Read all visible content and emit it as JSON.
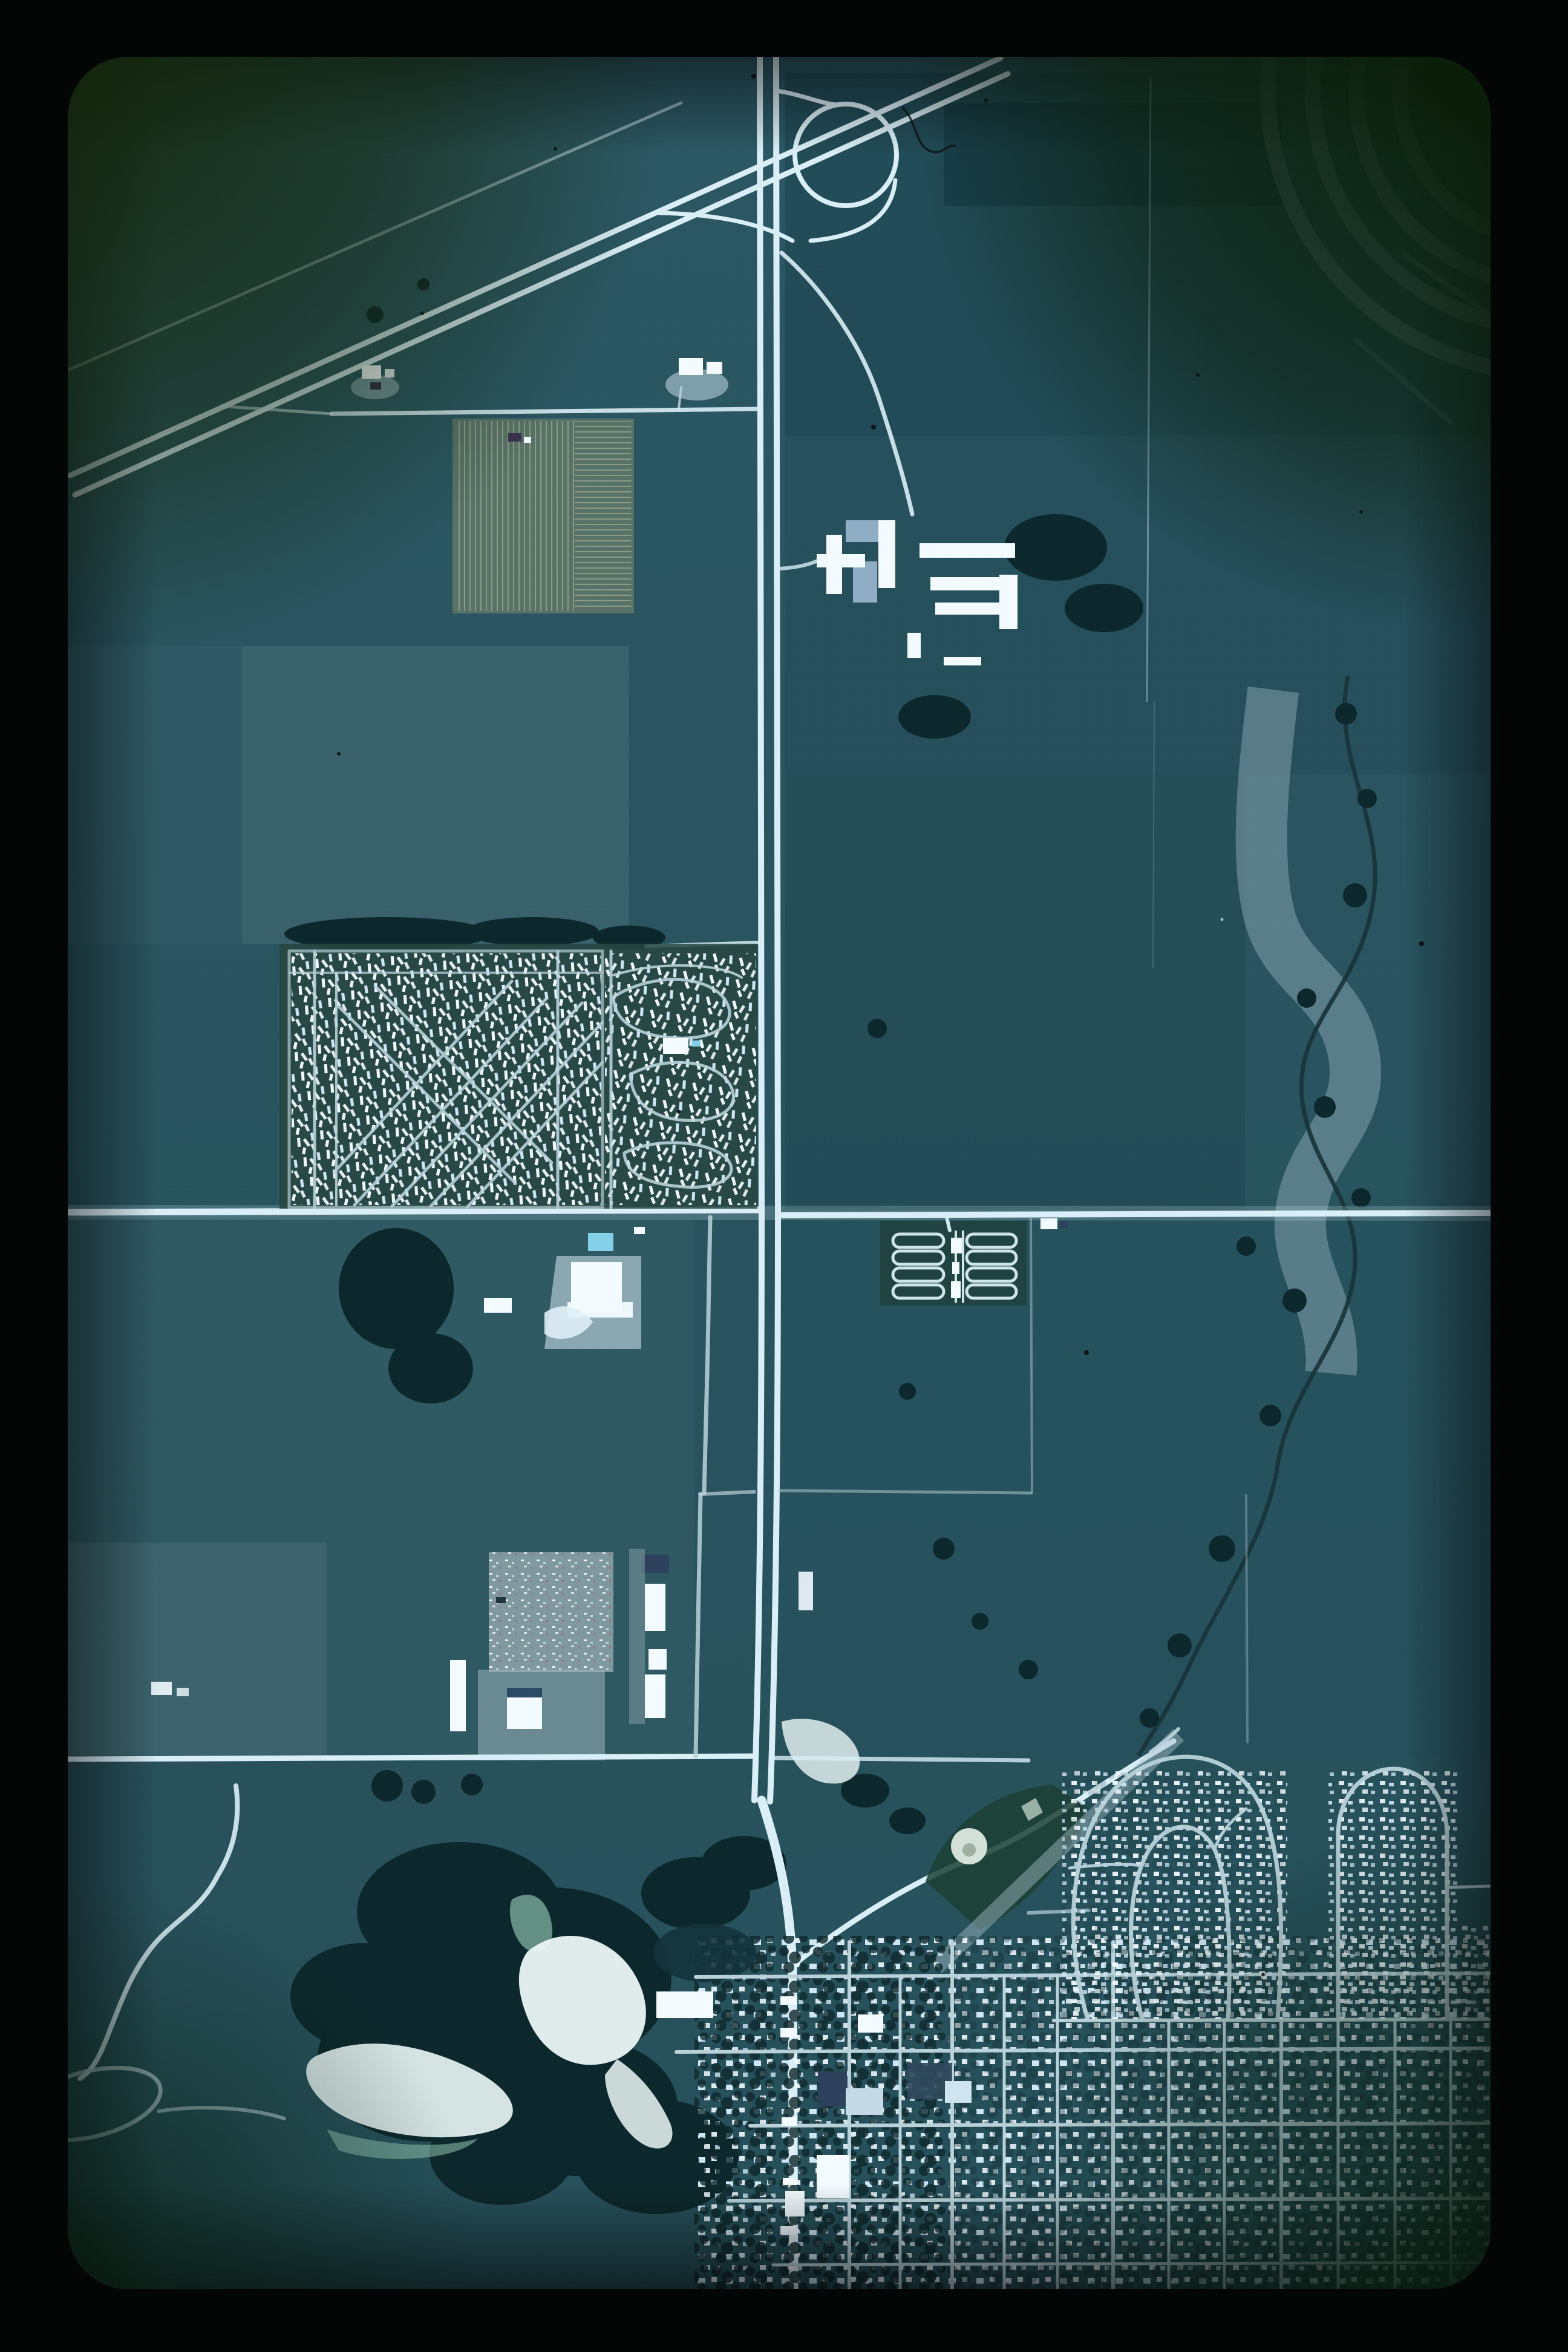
{
  "photo": {
    "caption": "Vertical color aerial photograph slide: a north-south divided highway with a loop-ramp interchange at top crosses farm fields, passes a large mobile-home park and campground at a bright east-west crossroad, and runs south into a small town with a street grid, curved subdivision, ball fields, sand pits and a meandering creek. Black film-mount border with dark green corner vignettes.",
    "kind": "aerial-photograph-slide",
    "visible_text": "none"
  },
  "palette": {
    "mount": "#040606",
    "base_top": "#2b5763",
    "base_bottom": "#26505a",
    "field_dark": "#1c4450",
    "field_darker": "#163a46",
    "field_mid": "#3c636e",
    "field_light": "#52757f",
    "khaki": "#5c7468",
    "khaki_line": "#9aa98f",
    "forest": "#0d282c",
    "road_bright": "#d9eef6",
    "road_pale": "#b9d2da",
    "building_white": "#f3fbff",
    "house_pale": "#cfe6f4",
    "roof_slate": "#8fadc4",
    "roof_dark": "#2e415c",
    "roof_violet": "#3a3350",
    "pool_blue": "#85cfe8",
    "sand_white": "#ecf7f7",
    "sand_green": "#9fd4be",
    "strip_pale": "#8ba7b3",
    "creek_dark": "#173339",
    "yard_pale": "#b7cfd8",
    "vignette_olive": "#14260a",
    "vignette_green": "#081c0e",
    "ballfield_green": "#1c4034"
  },
  "features": [
    {
      "name": "slide-mount-border",
      "kind": "film mount"
    },
    {
      "name": "highway-interchange-loop-ramp",
      "kind": "road"
    },
    {
      "name": "divided-highway-north-south",
      "kind": "road"
    },
    {
      "name": "diagonal-divided-highway-northwest",
      "kind": "road"
    },
    {
      "name": "east-west-crossroad-bright",
      "kind": "road"
    },
    {
      "name": "east-west-road-south",
      "kind": "road"
    },
    {
      "name": "mobile-home-park",
      "kind": "residential"
    },
    {
      "name": "campground-loop-rows",
      "kind": "recreation"
    },
    {
      "name": "farm-complex-long-barns",
      "kind": "agriculture"
    },
    {
      "name": "contour-strip-field",
      "kind": "agriculture"
    },
    {
      "name": "furrowed-khaki-field",
      "kind": "agriculture"
    },
    {
      "name": "commercial-building-with-pool",
      "kind": "commercial"
    },
    {
      "name": "salvage-yard",
      "kind": "industrial"
    },
    {
      "name": "warehouse-strip",
      "kind": "industrial"
    },
    {
      "name": "creek-corridor",
      "kind": "hydrology"
    },
    {
      "name": "sand-pits",
      "kind": "terrain"
    },
    {
      "name": "s-curve-road-and-loop",
      "kind": "road"
    },
    {
      "name": "ballfields",
      "kind": "recreation"
    },
    {
      "name": "town-street-grid",
      "kind": "urban"
    },
    {
      "name": "curved-subdivision",
      "kind": "residential"
    },
    {
      "name": "pond",
      "kind": "hydrology"
    },
    {
      "name": "film-scratches-and-dust",
      "kind": "artifact"
    }
  ]
}
